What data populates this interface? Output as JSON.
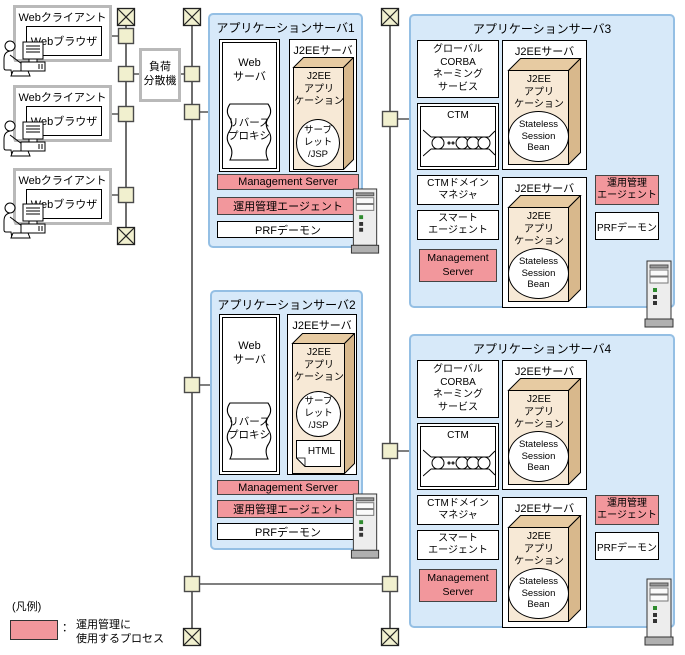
{
  "labels": {
    "web_client": "Webクライアント",
    "web_browser": "Webブラウザ",
    "load_balancer": "負荷\n分散機",
    "web_server": "Web\nサーバ",
    "reverse_proxy": "リバース\nプロキシ",
    "j2ee_server": "J2EEサーバ",
    "j2ee_application": "J2EE\nアプリ\nケーション",
    "servlet_jsp": "サーブ\nレット\n/JSP",
    "html_doc": "HTML",
    "management_server": "Management Server",
    "management_server_2line": "Management\nServer",
    "ops_agent": "運用管理エージェント",
    "ops_agent_2line": "運用管理\nエージェント",
    "prf_daemon": "PRFデーモン",
    "global_corba_naming": "グローバル\nCORBA\nネーミング\nサービス",
    "ctm": "CTM",
    "ctm_domain_manager": "CTMドメイン\nマネジャ",
    "smart_agent": "スマート\nエージェント",
    "stateless_session_bean": "Stateless\nSession\nBean"
  },
  "servers": {
    "app1": {
      "title": "アプリケーションサーバ1"
    },
    "app2": {
      "title": "アプリケーションサーバ2"
    },
    "app3": {
      "title": "アプリケーションサーバ3"
    },
    "app4": {
      "title": "アプリケーションサーバ4"
    }
  },
  "legend": {
    "heading": "(凡例)",
    "colon": "：",
    "label": "運用管理に\n使用するプロセス"
  },
  "icons": {
    "user": "user-at-computer-icon",
    "server": "server-tower-icon",
    "network_node": "network-node",
    "network_endpoint": "network-endpoint-x-icon",
    "ctm_queue": "ctm-queue-icon",
    "reverse_proxy_plaque": "reverse-proxy-plaque-shape",
    "html_document": "html-document-icon"
  },
  "colors": {
    "container_fill": "#d7e9f9",
    "container_border": "#94bfe4",
    "process_pink": "#f2979c",
    "box3d_front": "#f7e9d6",
    "box3d_top": "#e7cba2",
    "box3d_side": "#d8b88c",
    "node_yellow": "#f1f0cf",
    "client_border_gray": "#b9b9b9"
  }
}
